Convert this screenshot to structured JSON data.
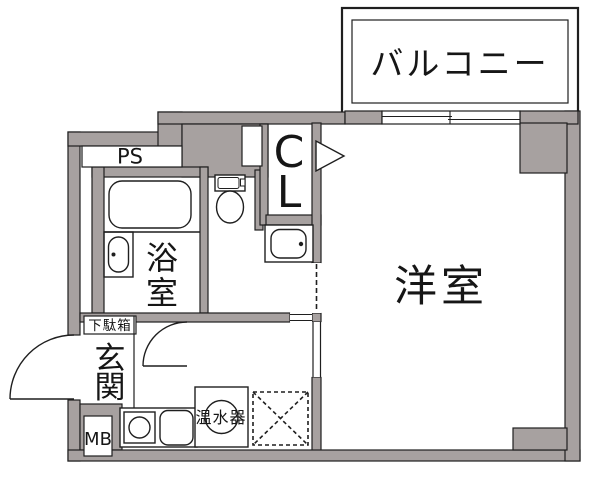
{
  "floorplan": {
    "title": "apartment-floorplan",
    "balcony": {
      "label": "バルコニー"
    },
    "pipe_space": {
      "label": "PS"
    },
    "closet": {
      "label": "CL",
      "chars": [
        "C",
        "L"
      ]
    },
    "bathroom": {
      "label": "浴室",
      "chars": [
        "浴",
        "室"
      ]
    },
    "western_room": {
      "label": "洋室"
    },
    "entrance": {
      "label": "玄関",
      "chars": [
        "玄",
        "関"
      ]
    },
    "shoe_box": {
      "label": "下駄箱"
    },
    "meter_box": {
      "label": "MB"
    },
    "water_heater": {
      "label": "温水器"
    },
    "fixtures": [
      "bathtub",
      "bath-sink",
      "toilet",
      "vanity-sink",
      "kitchen-stove",
      "kitchen-sink",
      "water-heater-tank",
      "washing-machine-space",
      "entrance-door",
      "hall-door",
      "closet-door-marker",
      "sliding-window"
    ],
    "colors": {
      "wall": "#a7a1a0",
      "line": "#1f1f1f",
      "background": "#ffffff"
    }
  }
}
